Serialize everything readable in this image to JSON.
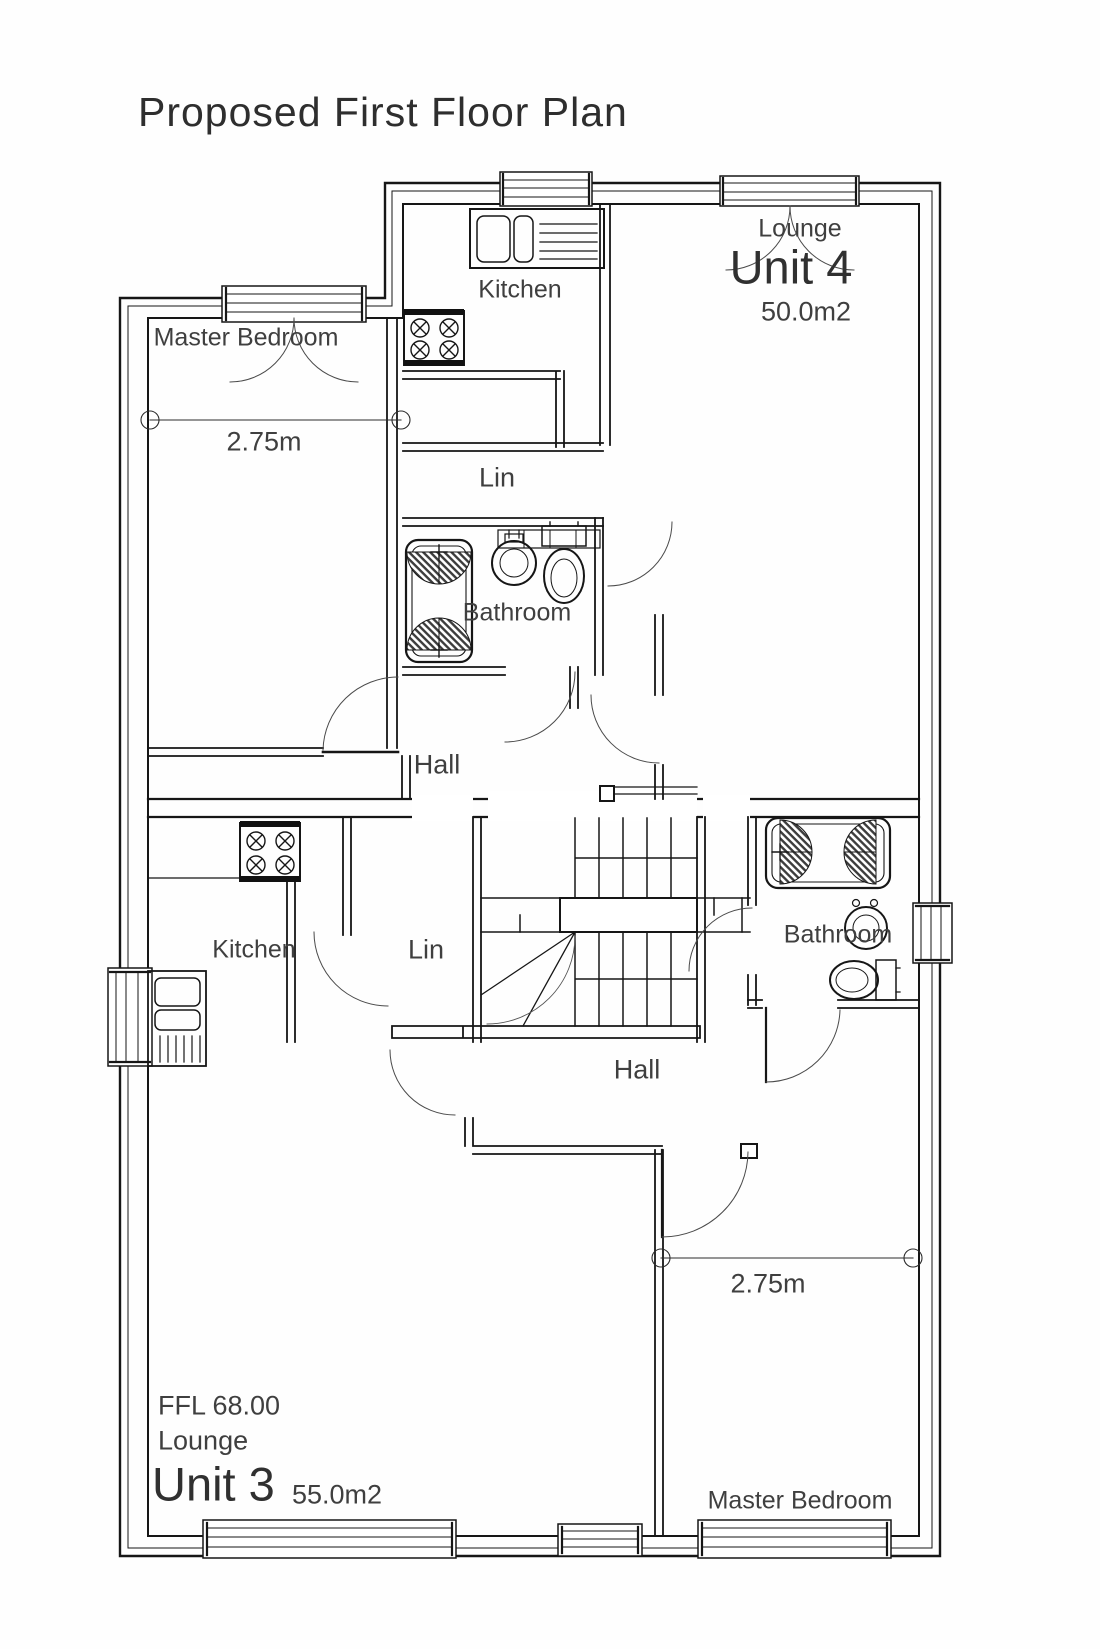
{
  "page": {
    "title": "Proposed First Floor Plan"
  },
  "colors": {
    "ink": "#1a1a1a",
    "text": "#3f3f3f"
  },
  "plan": {
    "unit4": {
      "name": "Unit 4",
      "area": "50.0m2",
      "dimension": "2.75m",
      "rooms": {
        "lounge": "Lounge",
        "kitchen": "Kitchen",
        "master_bedroom": "Master Bedroom",
        "bathroom": "Bathroom",
        "hall": "Hall",
        "linen": "Lin"
      }
    },
    "unit3": {
      "name": "Unit 3",
      "area": "55.0m2",
      "ffl": "FFL 68.00",
      "dimension": "2.75m",
      "rooms": {
        "lounge": "Lounge",
        "kitchen": "Kitchen",
        "master_bedroom": "Master Bedroom",
        "bathroom": "Bathroom",
        "hall": "Hall",
        "linen": "Lin"
      }
    }
  }
}
